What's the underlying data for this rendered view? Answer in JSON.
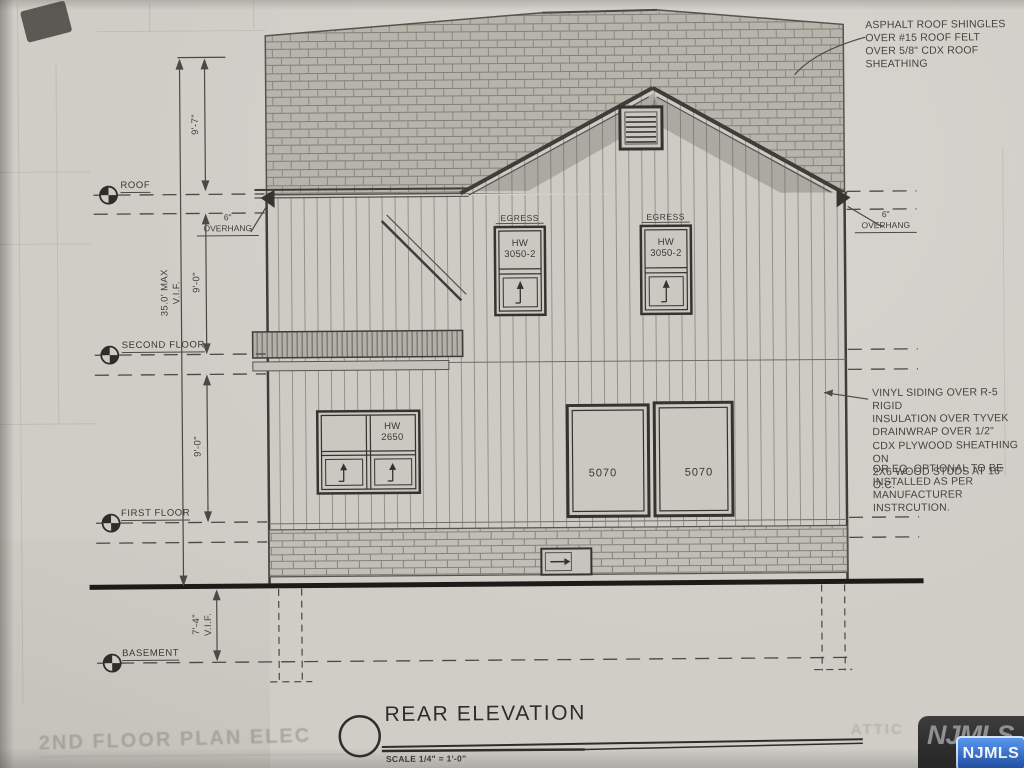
{
  "annotations": {
    "roof_note": "ASPHALT ROOF SHINGLES\nOVER #15 ROOF FELT\nOVER 5/8\" CDX ROOF\nSHEATHING",
    "siding_note_1": "VINYL SIDING  OVER R-5 RIGID\nINSULATION  OVER TYVEK\nDRAINWRAP OVER 1/2\"\nCDX PLYWOOD SHEATHING ON\n2X6  WOOD STUDS AT 16\" O.C.",
    "siding_note_2": "OR EQ. OPTIONAL TO BE\nINSTALLED AS PER\nMANUFACTURER\nINSTRCUTION.",
    "overhang_left": "6\"\nOVERHANG",
    "overhang_right": "6\"\nOVERHANG"
  },
  "levels": {
    "roof": "ROOF",
    "second": "SECOND FLOOR",
    "first": "FIRST FLOOR",
    "basement": "BASEMENT"
  },
  "dimensions": {
    "attic_height": "9'-7\"",
    "roof_to_second": "9'-0\"",
    "second_to_first": "9'-0\"",
    "overall_max": "35.0' MAX\nV.I.F.",
    "basement_depth": "7'-4\"\nV.I.F."
  },
  "windows": {
    "egress_label_left": "EGRESS",
    "egress_label_right": "EGRESS",
    "egress_size_left": "HW\n3050-2",
    "egress_size_right": "HW\n3050-2",
    "first_floor_size": "HW\n2650",
    "door_left": "5070",
    "door_right": "5070"
  },
  "title_block": {
    "title": "REAR ELEVATION",
    "scale": "SCALE 1/4\" = 1'-0\""
  },
  "watermark": {
    "mls_logo": "NJMLS",
    "mls_logo_bg": "NJMLS"
  },
  "bleed_through": {
    "bottom_left": "2ND FLOOR PLAN ELEC",
    "bottom_right": "ATTIC"
  },
  "colors": {
    "paper": "#cfcdc6",
    "ink": "#3c3b36",
    "badge_blue": "#1b55c0"
  }
}
